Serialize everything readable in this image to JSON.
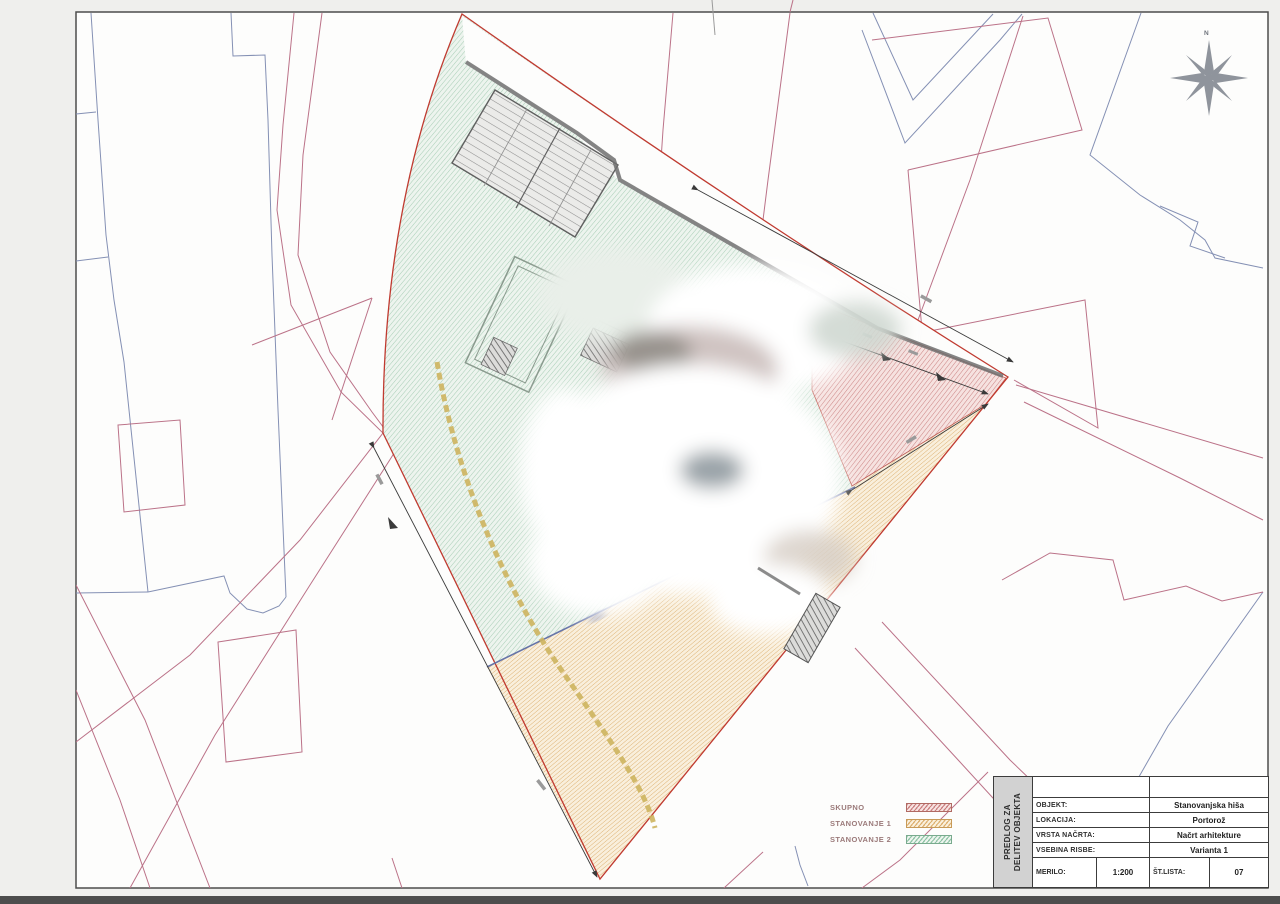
{
  "compass": {
    "label": "N"
  },
  "legend": {
    "items": [
      {
        "label": "SKUPNO",
        "hatch_color": "#c97f7f"
      },
      {
        "label": "STANOVANJE 1",
        "hatch_color": "#dcaf6e"
      },
      {
        "label": "STANOVANJE 2",
        "hatch_color": "#8fc3a6"
      }
    ]
  },
  "title_block": {
    "side_label_line1": "PREDLOG ZA",
    "side_label_line2": "DELITEV OBJEKTA",
    "rows": [
      {
        "label": "OBJEKT:",
        "value": "Stanovanjska hiša"
      },
      {
        "label": "LOKACIJA:",
        "value": "Portorož"
      },
      {
        "label": "VRSTA NAČRTA:",
        "value": "Načrt arhitekture"
      },
      {
        "label": "VSEBINA RISBE:",
        "value": "Varianta 1"
      }
    ],
    "scale_label": "MERILO:",
    "scale_value": "1:200",
    "sheet_label": "ŠT.LISTA:",
    "sheet_value": "07"
  },
  "colors": {
    "parcel_boundary": "#c03a30",
    "cadastral_pink": "#bb7288",
    "cadastral_blue": "#8490b4",
    "path_yellow": "#cdb45e",
    "divider_blue": "#6674a8",
    "wall_gray": "#6e6e6e"
  }
}
